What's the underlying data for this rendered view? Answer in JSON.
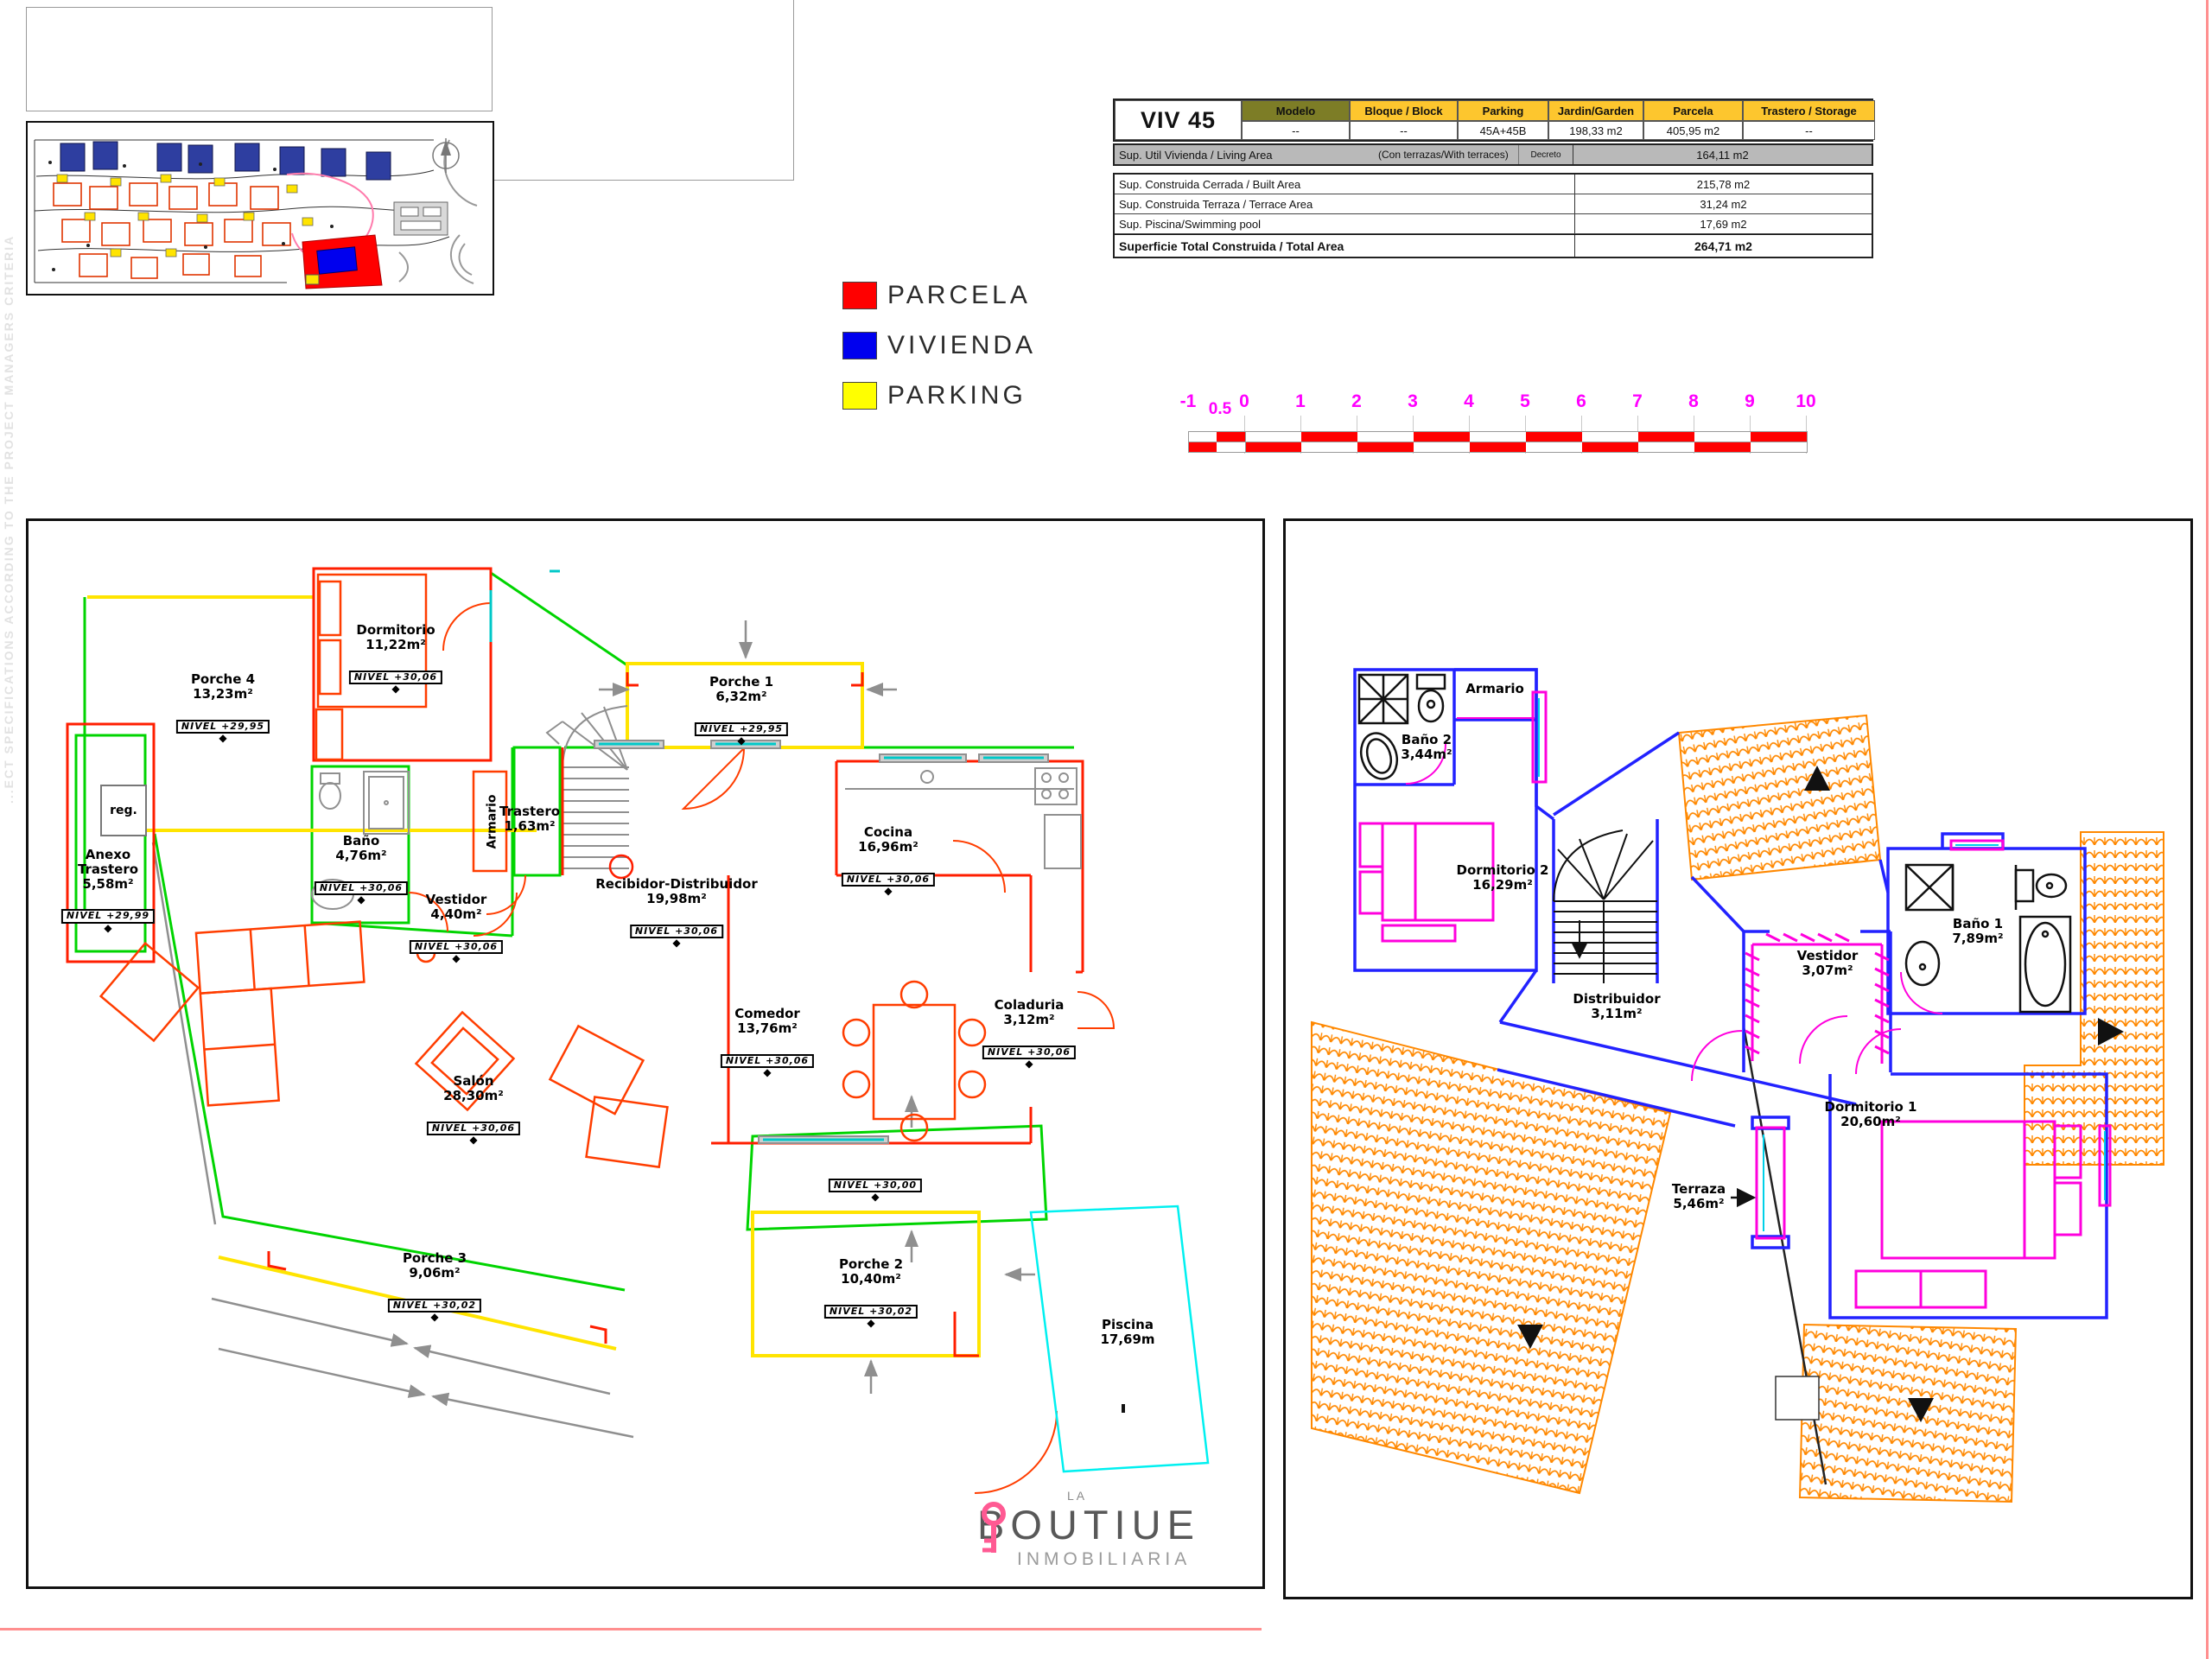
{
  "watermark": "...ECT SPECIFICATIONS ACCORDING TO THE PROJECT MANAGERS CRITERIA",
  "legend": {
    "items": [
      {
        "label": "PARCELA",
        "color": "#ff0000"
      },
      {
        "label": "VIVIENDA",
        "color": "#0000ee"
      },
      {
        "label": "PARKING",
        "color": "#ffff00"
      }
    ]
  },
  "info_table": {
    "unit_id": "VIV 45",
    "columns": [
      "Modelo",
      "Bloque / Block",
      "Parking",
      "Jardin/Garden",
      "Parcela",
      "Trastero / Storage"
    ],
    "values": [
      "--",
      "--",
      "45A+45B",
      "198,33 m2",
      "405,95 m2",
      "--"
    ],
    "living_label": "Sup. Util Vivienda / Living Area",
    "living_note": "(Con terrazas/With terraces)",
    "living_decree": "Decreto",
    "living_value": "164,11 m2",
    "rows": [
      {
        "label": "Sup. Construida Cerrada / Built Area",
        "value": "215,78 m2"
      },
      {
        "label": "Sup. Construida Terraza / Terrace Area",
        "value": "31,24 m2"
      },
      {
        "label": "Sup. Piscina/Swimming pool",
        "value": "17,69 m2"
      },
      {
        "label": "Superficie Total Construida / Total Area",
        "value": "264,71 m2"
      }
    ],
    "header_color": "#fdc62e",
    "modelo_color": "#7d7d26",
    "living_row_color": "#b9b9b9"
  },
  "scale_bar": {
    "labels": [
      "-1",
      "0.5",
      "0",
      "1",
      "2",
      "3",
      "4",
      "5",
      "6",
      "7",
      "8",
      "9",
      "10"
    ],
    "color": "#ff00ff",
    "bar_color": "#ff0000"
  },
  "ground_floor": {
    "reg_label": "reg.",
    "armario_label": "Armario",
    "rooms": [
      {
        "name": "Porche 4",
        "area": "13,23m²",
        "nivel": "NIVEL +29,95"
      },
      {
        "name": "Dormitorio",
        "area": "11,22m²",
        "nivel": "NIVEL +30,06"
      },
      {
        "name": "Anexo\nTrastero",
        "area": "5,58m²",
        "nivel": "NIVEL +29,99"
      },
      {
        "name": "Baño",
        "area": "4,76m²",
        "nivel": "NIVEL +30,06"
      },
      {
        "name": "Vestidor",
        "area": "4,40m²",
        "nivel": "NIVEL +30,06"
      },
      {
        "name": "Trastero",
        "area": "1,63m²",
        "nivel": ""
      },
      {
        "name": "Porche 1",
        "area": "6,32m²",
        "nivel": "NIVEL +29,95"
      },
      {
        "name": "Recibidor-Distribuidor",
        "area": "19,98m²",
        "nivel": "NIVEL +30,06"
      },
      {
        "name": "Cocina",
        "area": "16,96m²",
        "nivel": "NIVEL +30,06"
      },
      {
        "name": "Comedor",
        "area": "13,76m²",
        "nivel": "NIVEL +30,06"
      },
      {
        "name": "Coladuria",
        "area": "3,12m²",
        "nivel": "NIVEL +30,06"
      },
      {
        "name": "Salón",
        "area": "28,30m²",
        "nivel": "NIVEL +30,06"
      },
      {
        "name": "",
        "area": "",
        "nivel": "NIVEL +30,00"
      },
      {
        "name": "Porche 3",
        "area": "9,06m²",
        "nivel": "NIVEL +30,02"
      },
      {
        "name": "Porche 2",
        "area": "10,40m²",
        "nivel": "NIVEL +30,02"
      },
      {
        "name": "Piscina",
        "area": "17,69m",
        "nivel": ""
      }
    ]
  },
  "upper_floor": {
    "rooms": [
      {
        "name": "Baño 2",
        "area": "3,44m²"
      },
      {
        "name": "Armario",
        "area": ""
      },
      {
        "name": "Dormitorio 2",
        "area": "16,29m²"
      },
      {
        "name": "Distribuidor",
        "area": "3,11m²"
      },
      {
        "name": "Vestidor",
        "area": "3,07m²"
      },
      {
        "name": "Baño 1",
        "area": "7,89m²"
      },
      {
        "name": "Dormitorio 1",
        "area": "20,60m²"
      },
      {
        "name": "Terraza",
        "area": "5,46m²"
      }
    ]
  },
  "logo": {
    "top": "LA",
    "main_left": "BOUTI",
    "main_right": "UE",
    "sub": "INMOBILIARIA",
    "key_color": "#ff5a93"
  }
}
